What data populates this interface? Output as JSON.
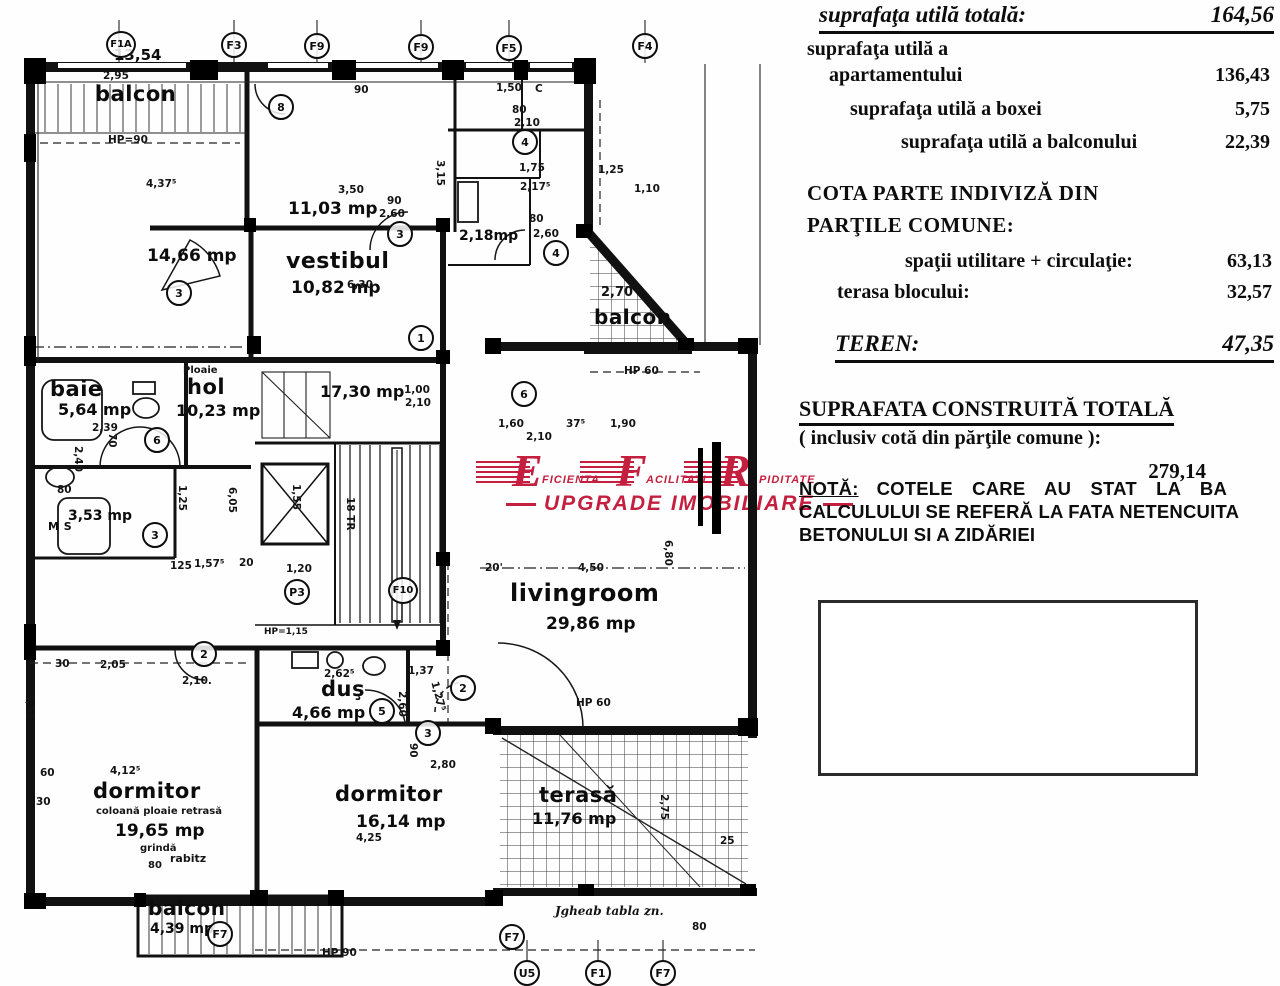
{
  "panel": {
    "row1_label": "suprafaţa utilă totală:",
    "row1_value": "164,56",
    "row2a": "suprafaţa utilă a",
    "row2b": "apartamentului",
    "row2_value": "136,43",
    "row3_label": "suprafaţa utilă a boxei",
    "row3_value": "5,75",
    "row4_label": "suprafaţa utilă a balconului",
    "row4_value": "22,39",
    "cota_title1": "COTA PARTE INDIVIZĂ DIN",
    "cota_title2": "PARŢILE COMUNE:",
    "cota_row1_label": "spaţii utilitare + circulaţie:",
    "cota_row1_value": "63,13",
    "cota_row2_label": "terasa blocului:",
    "cota_row2_value": "32,57",
    "teren_label": "TEREN:",
    "teren_value": "47,35",
    "sct_title": "SUPRAFATA CONSTRUITĂ TOTALĂ",
    "sct_sub": "( inclusiv cotă din părţile comune ):",
    "sct_value": "279,14",
    "nota_label": "NOTĂ:",
    "nota_line1": "COTELE  CARE  AU  STAT  LA  BA",
    "nota_line2": "CALCULULUI SE REFERĂ LA FATA NETENCUITA",
    "nota_line3": "BETONULUI SI A ZIDĂRIEI"
  },
  "watermark": {
    "color": "#c41f3e",
    "units": [
      {
        "letter": "E",
        "word": "FICIENTA"
      },
      {
        "letter": "F",
        "word": "ACILITATI"
      },
      {
        "letter": "R",
        "word": "APIDITATE"
      }
    ],
    "tagline": "UPGRADE IMOBILIARE"
  },
  "plan": {
    "rooms": [
      {
        "name": "balcon",
        "area": "13,54",
        "np": [
          95,
          82
        ],
        "nfs": 21,
        "ap": [
          114,
          46
        ],
        "afs": 15
      },
      {
        "name": "",
        "area": "14,66 mp",
        "ap": [
          147,
          246
        ],
        "afs": 17
      },
      {
        "name": "",
        "area": "11,03 mp",
        "ap": [
          288,
          199
        ],
        "afs": 17
      },
      {
        "name": "vestibul",
        "area": "10,82 mp",
        "np": [
          286,
          249
        ],
        "nfs": 22,
        "ap": [
          291,
          278
        ],
        "afs": 17
      },
      {
        "name": "baie",
        "area": "5,64 mp",
        "np": [
          50,
          377
        ],
        "nfs": 21,
        "ap": [
          58,
          400
        ],
        "afs": 16
      },
      {
        "name": "hol",
        "area": "10,23 mp",
        "np": [
          187,
          375
        ],
        "nfs": 21,
        "ap": [
          176,
          401
        ],
        "afs": 16
      },
      {
        "name": "M S",
        "area": "3,53 mp",
        "np": [
          48,
          520
        ],
        "nfs": 11,
        "ap": [
          68,
          508
        ],
        "afs": 14
      },
      {
        "name": "",
        "area": "17,30 mp",
        "ap": [
          320,
          382
        ],
        "afs": 16
      },
      {
        "name": "",
        "area": "2,18mp",
        "ap": [
          459,
          228
        ],
        "afs": 14
      },
      {
        "name": "livingroom",
        "area": "29,86 mp",
        "np": [
          510,
          579
        ],
        "nfs": 24,
        "ap": [
          546,
          614
        ],
        "afs": 17
      },
      {
        "name": "duş",
        "area": "4,66 mp",
        "np": [
          321,
          677
        ],
        "nfs": 21,
        "ap": [
          292,
          703
        ],
        "afs": 16
      },
      {
        "name": "dormitor",
        "area": "16,14 mp",
        "np": [
          335,
          782
        ],
        "nfs": 21,
        "ap": [
          356,
          812
        ],
        "afs": 17
      },
      {
        "name": "dormitor",
        "area": "19,65 mp",
        "np": [
          93,
          779
        ],
        "nfs": 21,
        "ap": [
          115,
          821
        ],
        "afs": 17,
        "notes": [
          {
            "t": "coloană ploaie retrasă",
            "p": [
              96,
              806
            ],
            "fs": 10
          },
          {
            "t": "grindă",
            "p": [
              140,
              843
            ],
            "fs": 10
          },
          {
            "t": "rabitz",
            "p": [
              170,
              852
            ],
            "fs": 11
          },
          {
            "t": "80",
            "p": [
              148,
              860
            ],
            "fs": 10
          }
        ]
      },
      {
        "name": "terasă",
        "area": "11,76 mp",
        "np": [
          539,
          783
        ],
        "nfs": 21,
        "ap": [
          532,
          809
        ],
        "afs": 16
      },
      {
        "name": "balcon",
        "area": "4,39 mp",
        "np": [
          148,
          896
        ],
        "nfs": 20,
        "ap": [
          150,
          921
        ],
        "afs": 14
      },
      {
        "name": "balcon",
        "area": "",
        "np": [
          594,
          305
        ],
        "nfs": 20
      }
    ],
    "dims": [
      {
        "t": "2,95",
        "x": 103,
        "y": 70
      },
      {
        "t": "HP=90",
        "x": 108,
        "y": 134
      },
      {
        "t": "4,37⁵",
        "x": 146,
        "y": 178
      },
      {
        "t": "90",
        "x": 354,
        "y": 84
      },
      {
        "t": "1,50",
        "x": 496,
        "y": 82
      },
      {
        "t": "C",
        "x": 535,
        "y": 83
      },
      {
        "t": "80",
        "x": 512,
        "y": 104
      },
      {
        "t": "2,10",
        "x": 514,
        "y": 117
      },
      {
        "t": "3,50",
        "x": 338,
        "y": 184
      },
      {
        "t": "90",
        "x": 387,
        "y": 195
      },
      {
        "t": "2,60",
        "x": 379,
        "y": 208
      },
      {
        "t": "6,30",
        "x": 347,
        "y": 279
      },
      {
        "t": "1,75",
        "x": 519,
        "y": 162
      },
      {
        "t": "2,17⁵",
        "x": 520,
        "y": 181
      },
      {
        "t": "80",
        "x": 529,
        "y": 213
      },
      {
        "t": "2,60",
        "x": 533,
        "y": 228
      },
      {
        "t": "3,15",
        "x": 446,
        "y": 160,
        "r": 90
      },
      {
        "t": "1,10",
        "x": 634,
        "y": 183
      },
      {
        "t": "1,25",
        "x": 598,
        "y": 164
      },
      {
        "t": "2,70",
        "x": 601,
        "y": 285,
        "fs": 13
      },
      {
        "t": "HP 60",
        "x": 624,
        "y": 365
      },
      {
        "t": "1,00",
        "x": 404,
        "y": 384
      },
      {
        "t": "2,10",
        "x": 405,
        "y": 397
      },
      {
        "t": "1,60",
        "x": 498,
        "y": 418
      },
      {
        "t": "37⁵",
        "x": 566,
        "y": 418
      },
      {
        "t": "1,90",
        "x": 610,
        "y": 418
      },
      {
        "t": "2,10",
        "x": 526,
        "y": 431
      },
      {
        "t": "6,80",
        "x": 674,
        "y": 540,
        "r": 90
      },
      {
        "t": "20'",
        "x": 485,
        "y": 562
      },
      {
        "t": "4,50",
        "x": 578,
        "y": 562
      },
      {
        "t": "HP 60",
        "x": 576,
        "y": 697
      },
      {
        "t": "Ploaie",
        "x": 183,
        "y": 365,
        "fs": 10
      },
      {
        "t": "2,39",
        "x": 92,
        "y": 422
      },
      {
        "t": "70",
        "x": 118,
        "y": 433,
        "r": 90
      },
      {
        "t": "2,40",
        "x": 84,
        "y": 446,
        "r": 90
      },
      {
        "t": "80",
        "x": 57,
        "y": 484
      },
      {
        "t": "1,25",
        "x": 188,
        "y": 485,
        "r": 90
      },
      {
        "t": "6,05",
        "x": 238,
        "y": 487,
        "r": 90
      },
      {
        "t": "125",
        "x": 170,
        "y": 560
      },
      {
        "t": "1,57⁵",
        "x": 194,
        "y": 558
      },
      {
        "t": "20",
        "x": 239,
        "y": 557
      },
      {
        "t": "1,55",
        "x": 302,
        "y": 484,
        "r": 90
      },
      {
        "t": "18 TR",
        "x": 356,
        "y": 497,
        "r": 90
      },
      {
        "t": "1,20",
        "x": 286,
        "y": 563
      },
      {
        "t": "HP=1,15",
        "x": 264,
        "y": 627,
        "fs": 9
      },
      {
        "t": "30",
        "x": 55,
        "y": 658
      },
      {
        "t": "2,05",
        "x": 100,
        "y": 659
      },
      {
        "t": "2,10.",
        "x": 182,
        "y": 675
      },
      {
        "t": "2,62⁵",
        "x": 324,
        "y": 668
      },
      {
        "t": "1,37",
        "x": 408,
        "y": 665
      },
      {
        "t": "2,60",
        "x": 408,
        "y": 691,
        "r": 90
      },
      {
        "t": "90",
        "x": 419,
        "y": 743,
        "r": 90
      },
      {
        "t": "2,80",
        "x": 430,
        "y": 759
      },
      {
        "t": "1,27⁵",
        "x": 440,
        "y": 680,
        "r": 75
      },
      {
        "t": "4,55",
        "x": 36,
        "y": 694,
        "r": 90
      },
      {
        "t": "60",
        "x": 40,
        "y": 767
      },
      {
        "t": "30",
        "x": 36,
        "y": 796
      },
      {
        "t": "4,12⁵",
        "x": 110,
        "y": 765
      },
      {
        "t": "4,25",
        "x": 356,
        "y": 832
      },
      {
        "t": "2,75",
        "x": 670,
        "y": 794,
        "r": 90
      },
      {
        "t": "25",
        "x": 720,
        "y": 835
      },
      {
        "t": "HP 90",
        "x": 322,
        "y": 947
      },
      {
        "t": "80",
        "x": 692,
        "y": 921
      },
      {
        "t": "Jgheab tabla zn.",
        "x": 555,
        "y": 904,
        "fs": 12,
        "hand": true
      }
    ],
    "markers": [
      {
        "t": "F1A",
        "x": 106,
        "y": 31
      },
      {
        "t": "F3",
        "x": 221,
        "y": 32
      },
      {
        "t": "F9",
        "x": 304,
        "y": 33
      },
      {
        "t": "F9",
        "x": 408,
        "y": 34
      },
      {
        "t": "F5",
        "x": 496,
        "y": 35
      },
      {
        "t": "F4",
        "x": 632,
        "y": 33
      },
      {
        "t": "8",
        "x": 268,
        "y": 94
      },
      {
        "t": "4",
        "x": 512,
        "y": 129
      },
      {
        "t": "3",
        "x": 387,
        "y": 221
      },
      {
        "t": "4",
        "x": 543,
        "y": 240
      },
      {
        "t": "3",
        "x": 166,
        "y": 280
      },
      {
        "t": "1",
        "x": 408,
        "y": 325
      },
      {
        "t": "6",
        "x": 511,
        "y": 381
      },
      {
        "t": "6",
        "x": 144,
        "y": 427
      },
      {
        "t": "3",
        "x": 142,
        "y": 522
      },
      {
        "t": "P3",
        "x": 284,
        "y": 579
      },
      {
        "t": "F10",
        "x": 388,
        "y": 577
      },
      {
        "t": "2",
        "x": 191,
        "y": 641
      },
      {
        "t": "5",
        "x": 369,
        "y": 698
      },
      {
        "t": "2",
        "x": 450,
        "y": 675
      },
      {
        "t": "3",
        "x": 415,
        "y": 720
      },
      {
        "t": "F7",
        "x": 207,
        "y": 921
      },
      {
        "t": "F7",
        "x": 499,
        "y": 924
      },
      {
        "t": "U5",
        "x": 514,
        "y": 960
      },
      {
        "t": "F1",
        "x": 585,
        "y": 960
      },
      {
        "t": "F7",
        "x": 650,
        "y": 960
      }
    ]
  }
}
